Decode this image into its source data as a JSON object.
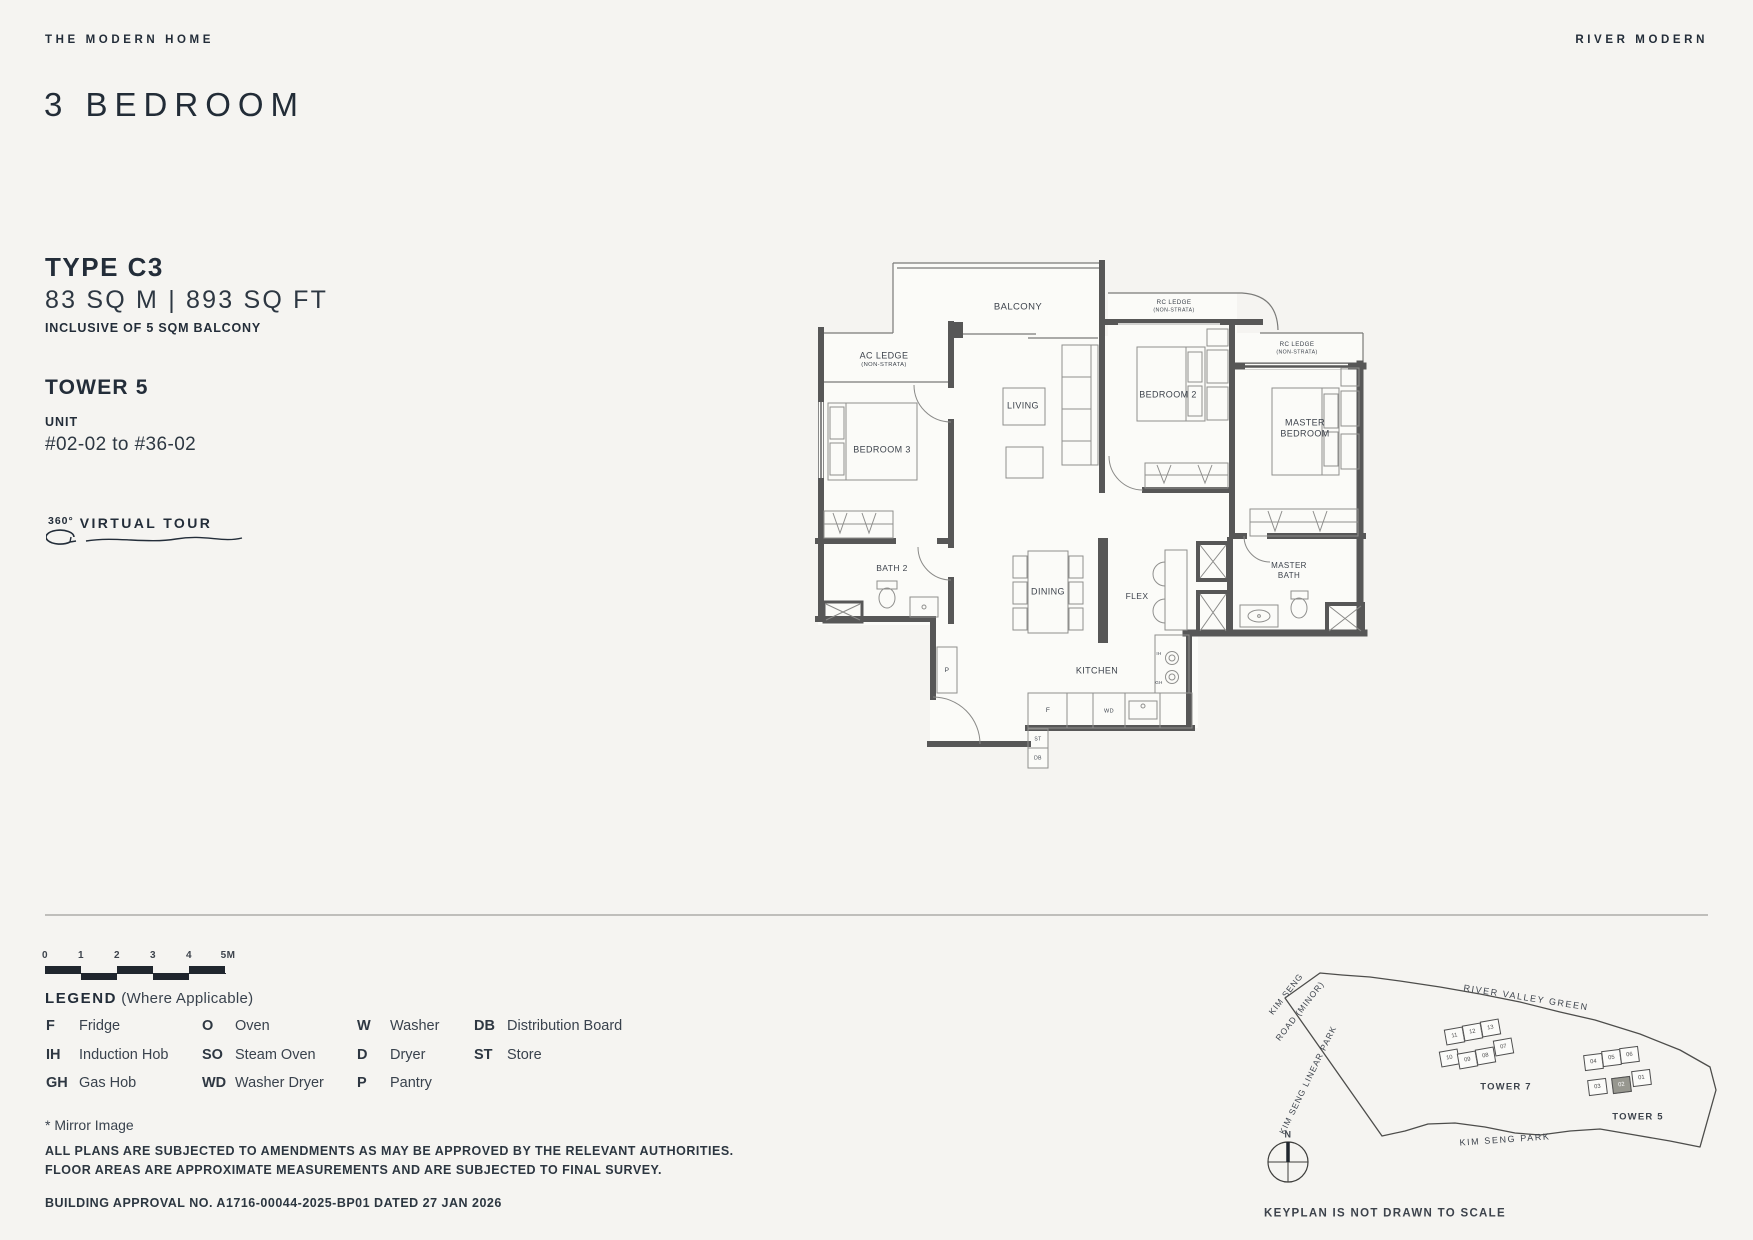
{
  "header": {
    "brand_left": "THE MODERN HOME",
    "brand_right": "RIVER MODERN",
    "title": "3 BEDROOM"
  },
  "info": {
    "type": "TYPE C3",
    "area": "83 SQ M | 893 SQ FT",
    "area_note": "INCLUSIVE OF 5 SQM BALCONY",
    "tower": "TOWER 5",
    "unit_label": "UNIT",
    "unit_range": "#02-02 to #36-02",
    "tour_degree": "360°",
    "tour_label": "VIRTUAL TOUR"
  },
  "floorplan": {
    "labels": [
      {
        "t": "BALCONY",
        "x": 218,
        "y": 57,
        "fs": 9.5
      },
      {
        "t": "AC LEDGE",
        "x": 84,
        "y": 106,
        "fs": 9
      },
      {
        "t": "(NON-STRATA)",
        "x": 84,
        "y": 116,
        "fs": 5.8
      },
      {
        "t": "RC LEDGE",
        "x": 374,
        "y": 53,
        "fs": 6.2
      },
      {
        "t": "(NON-STRATA)",
        "x": 374,
        "y": 60.5,
        "fs": 5.2
      },
      {
        "t": "RC LEDGE",
        "x": 497,
        "y": 95,
        "fs": 6.2
      },
      {
        "t": "(NON-STRATA)",
        "x": 497,
        "y": 102.5,
        "fs": 5.2
      },
      {
        "t": "LIVING",
        "x": 223,
        "y": 156,
        "fs": 9
      },
      {
        "t": "BEDROOM 2",
        "x": 368,
        "y": 145,
        "fs": 9
      },
      {
        "t": "MASTER",
        "x": 505,
        "y": 173,
        "fs": 9
      },
      {
        "t": "BEDROOM",
        "x": 505,
        "y": 184,
        "fs": 9
      },
      {
        "t": "BEDROOM 3",
        "x": 82,
        "y": 200,
        "fs": 9
      },
      {
        "t": "BATH 2",
        "x": 92,
        "y": 318,
        "fs": 8.5
      },
      {
        "t": "DINING",
        "x": 248,
        "y": 342,
        "fs": 9
      },
      {
        "t": "FLEX",
        "x": 337,
        "y": 346,
        "fs": 8.5
      },
      {
        "t": "MASTER",
        "x": 489,
        "y": 316,
        "fs": 8
      },
      {
        "t": "BATH",
        "x": 489,
        "y": 326,
        "fs": 8
      },
      {
        "t": "KITCHEN",
        "x": 297,
        "y": 421,
        "fs": 9
      },
      {
        "t": "P",
        "x": 147,
        "y": 421,
        "fs": 6.5
      },
      {
        "t": "F",
        "x": 248,
        "y": 461,
        "fs": 6.5
      },
      {
        "t": "WD",
        "x": 309,
        "y": 462,
        "fs": 5.5
      },
      {
        "t": "ST",
        "x": 238,
        "y": 490,
        "fs": 5
      },
      {
        "t": "DB",
        "x": 238,
        "y": 509,
        "fs": 5
      },
      {
        "t": "IH",
        "x": 359,
        "y": 404,
        "fs": 4.5
      },
      {
        "t": "GH",
        "x": 359,
        "y": 433,
        "fs": 4.5
      }
    ]
  },
  "scalebar": {
    "ticks": [
      {
        "t": "0",
        "x": 0,
        "y": 8,
        "fs": 10,
        "b": 1
      },
      {
        "t": "1",
        "x": 36,
        "y": 8,
        "fs": 10,
        "b": 1
      },
      {
        "t": "2",
        "x": 72,
        "y": 8,
        "fs": 10,
        "b": 1
      },
      {
        "t": "3",
        "x": 108,
        "y": 8,
        "fs": 10,
        "b": 1
      },
      {
        "t": "4",
        "x": 144,
        "y": 8,
        "fs": 10,
        "b": 1
      },
      {
        "t": "5M",
        "x": 183,
        "y": 8,
        "fs": 10,
        "b": 1
      }
    ]
  },
  "legend": {
    "title": "LEGEND",
    "subtitle": "(Where Applicable)",
    "columns": [
      [
        {
          "abbr": "F",
          "term": "Fridge"
        },
        {
          "abbr": "IH",
          "term": "Induction Hob"
        },
        {
          "abbr": "GH",
          "term": "Gas Hob"
        }
      ],
      [
        {
          "abbr": "O",
          "term": "Oven"
        },
        {
          "abbr": "SO",
          "term": "Steam Oven"
        },
        {
          "abbr": "WD",
          "term": "Washer Dryer"
        }
      ],
      [
        {
          "abbr": "W",
          "term": "Washer"
        },
        {
          "abbr": "D",
          "term": "Dryer"
        },
        {
          "abbr": "P",
          "term": "Pantry"
        }
      ],
      [
        {
          "abbr": "DB",
          "term": "Distribution Board"
        },
        {
          "abbr": "ST",
          "term": "Store"
        }
      ]
    ],
    "mirror_note": "* Mirror Image"
  },
  "notes": {
    "line1": "ALL PLANS ARE SUBJECTED TO AMENDMENTS AS MAY BE APPROVED BY THE RELEVANT AUTHORITIES.",
    "line2": "FLOOR AREAS ARE APPROXIMATE MEASUREMENTS AND ARE SUBJECTED TO FINAL SURVEY.",
    "approval": "BUILDING APPROVAL NO. A1716-00044-2025-BP01 DATED 27 JAN 2026"
  },
  "keyplan": {
    "labels": [
      {
        "t": "KIM SENG",
        "x": 46,
        "y": 54,
        "fs": 8.5,
        "rot": -52,
        "ls": 1
      },
      {
        "t": "ROAD (MINOR)",
        "x": 60,
        "y": 71,
        "fs": 8.5,
        "rot": -52,
        "ls": 1
      },
      {
        "t": "RIVER VALLEY GREEN",
        "x": 286,
        "y": 58,
        "fs": 9,
        "rot": 9,
        "ls": 1.6
      },
      {
        "t": "KIM SENG LINEAR PARK",
        "x": 68,
        "y": 140,
        "fs": 8.5,
        "rot": -64,
        "ls": 1
      },
      {
        "t": "TOWER 7",
        "x": 266,
        "y": 147,
        "fs": 9.5,
        "b": 1,
        "ls": 1.2
      },
      {
        "t": "TOWER 5",
        "x": 398,
        "y": 177,
        "fs": 9.5,
        "b": 1,
        "ls": 1.2
      },
      {
        "t": "KIM SENG PARK",
        "x": 265,
        "y": 200,
        "fs": 9,
        "rot": -4,
        "ls": 1.6
      },
      {
        "t": "N",
        "x": 48,
        "y": 195,
        "fs": 9,
        "b": 1
      },
      {
        "t": "KEYPLAN IS NOT DRAWN TO SCALE",
        "x": 24,
        "y": 274,
        "fs": 11.5,
        "b": 1,
        "ls": 1.3,
        "anchor": "l"
      }
    ],
    "tower7_units": [
      {
        "n": "11",
        "x": 205,
        "y": 88,
        "rot": -10
      },
      {
        "n": "12",
        "x": 223,
        "y": 84,
        "rot": -10
      },
      {
        "n": "13",
        "x": 241,
        "y": 80,
        "rot": -10
      },
      {
        "n": "07",
        "x": 254,
        "y": 99,
        "rot": -10
      },
      {
        "n": "10",
        "x": 200,
        "y": 110,
        "rot": -10
      },
      {
        "n": "09",
        "x": 218,
        "y": 112,
        "rot": -10
      },
      {
        "n": "08",
        "x": 236,
        "y": 108,
        "rot": -10
      }
    ],
    "tower5_units": [
      {
        "n": "04",
        "x": 344,
        "y": 114,
        "rot": -7
      },
      {
        "n": "05",
        "x": 362,
        "y": 110,
        "rot": -7
      },
      {
        "n": "06",
        "x": 380,
        "y": 107,
        "rot": -7
      },
      {
        "n": "03",
        "x": 348,
        "y": 139,
        "rot": -7
      },
      {
        "n": "02",
        "x": 372,
        "y": 137,
        "rot": -7,
        "hl": 1
      },
      {
        "n": "01",
        "x": 392,
        "y": 130,
        "rot": -7
      }
    ]
  }
}
